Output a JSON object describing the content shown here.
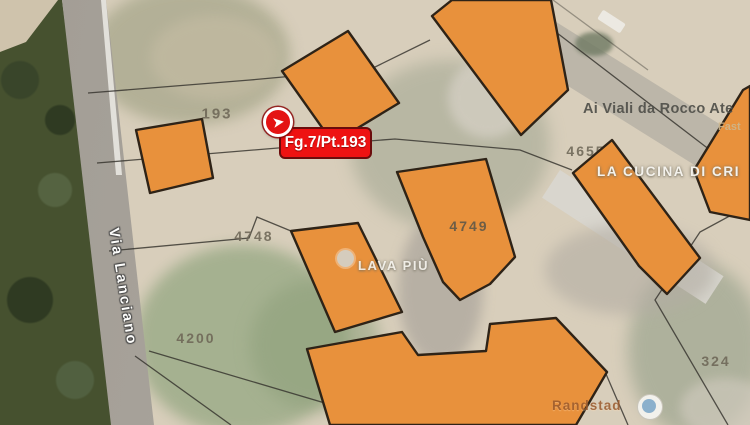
{
  "map": {
    "marker": {
      "label": "Fg.7/Pt.193",
      "icon": "red-arrow-pin"
    },
    "street": {
      "name": "Via Lanciano"
    },
    "parcels": [
      {
        "number": "193"
      },
      {
        "number": "4748"
      },
      {
        "number": "4749"
      },
      {
        "number": "4200"
      },
      {
        "number": "4655"
      },
      {
        "number": "324"
      }
    ],
    "pois": [
      {
        "name": "Ai Viali da Rocco Ate"
      },
      {
        "name": "Fast"
      },
      {
        "name": "LA CUCINA DI CRI"
      },
      {
        "name": "LAVA PIÙ"
      },
      {
        "name": "Randstad"
      }
    ],
    "colors": {
      "building_fill": "#E8913C",
      "building_stroke": "#2E2317",
      "marker_red": "#E41313",
      "label_bg": "#EE1212",
      "label_border": "#6B0C0C",
      "ground_tan": "#D8CEBB",
      "road_gray": "#A8A29B",
      "vegetation_green": "#46512F",
      "parcel_line": "#32302A"
    }
  }
}
